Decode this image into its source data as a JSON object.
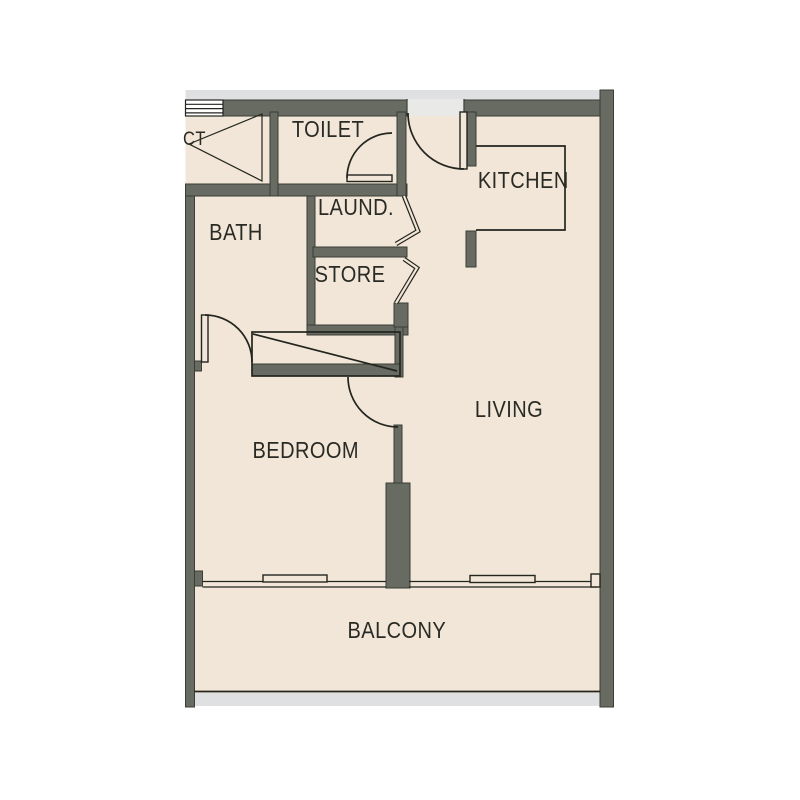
{
  "colors": {
    "bg": "#ffffff",
    "floor": "#f1e6d7",
    "wall": "#676b62",
    "wallline": "#3a3e35",
    "line": "#23251f",
    "slab": "#dfe0e1",
    "doorway": "#e9e9e8",
    "text": "#2a2a25"
  },
  "rooms": {
    "toilet": {
      "label": "TOILET"
    },
    "kitchen": {
      "label": "KITCHEN"
    },
    "laundry": {
      "label": "LAUND."
    },
    "bath": {
      "label": "BATH"
    },
    "store": {
      "label": "STORE"
    },
    "living": {
      "label": "LIVING"
    },
    "bedroom": {
      "label": "BEDROOM"
    },
    "balcony": {
      "label": "BALCONY"
    },
    "duct": {
      "label": "CT"
    }
  }
}
